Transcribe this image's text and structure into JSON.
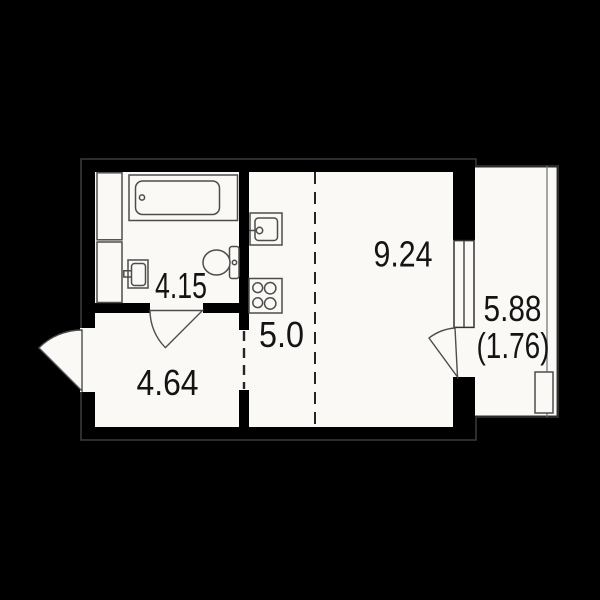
{
  "plan": {
    "rooms": {
      "bathroom": {
        "area": "4.15"
      },
      "kitchen": {
        "area": "5.0"
      },
      "living": {
        "area": "9.24"
      },
      "hallway": {
        "area": "4.64"
      },
      "balcony": {
        "area": "5.88",
        "area_secondary": "(1.76)"
      }
    },
    "colors": {
      "background": "#000000",
      "floor": "#faf9f6",
      "fixture_line": "#4d4d4d",
      "label_text": "#141414",
      "outer_wall_outline": "#3c3c3c"
    }
  }
}
